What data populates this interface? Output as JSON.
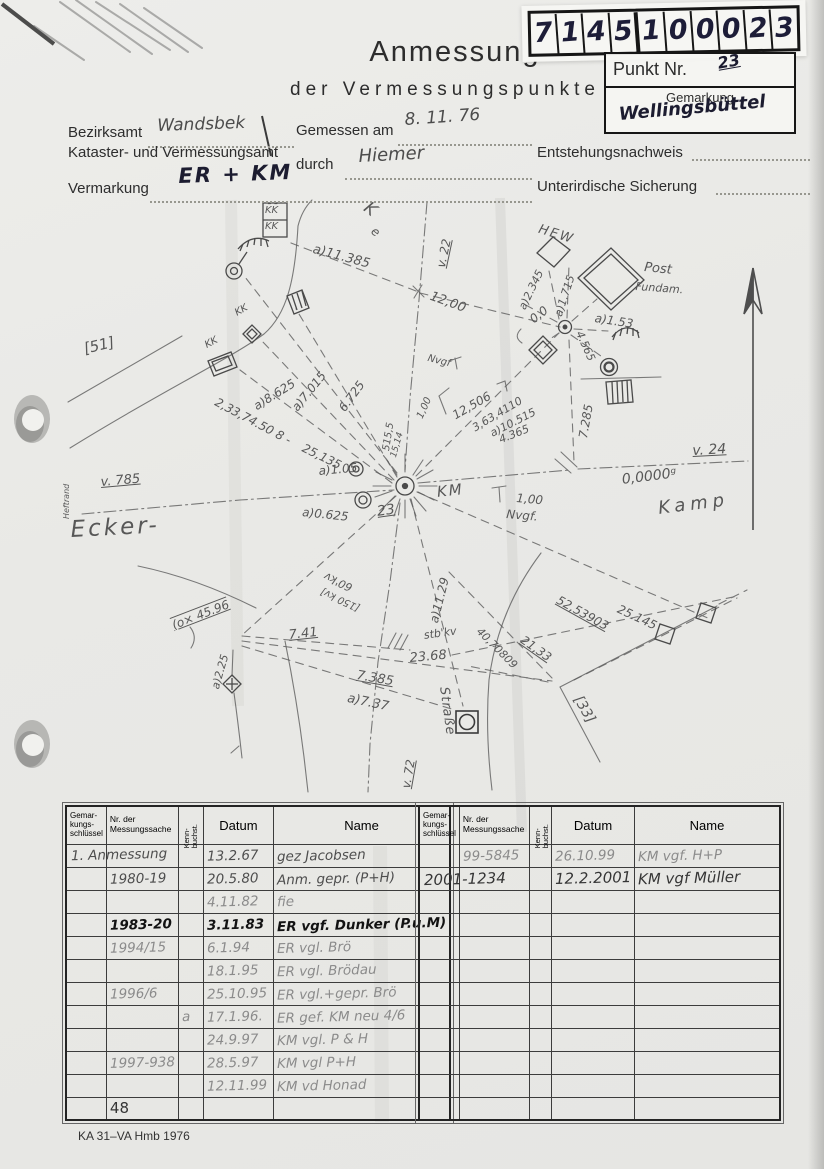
{
  "stamp": {
    "digits": [
      "7",
      "1",
      "4",
      "5",
      "1",
      "0",
      "0",
      "0",
      "2",
      "3"
    ]
  },
  "title": {
    "line1": "Anmessung",
    "line2": "der Vermessungspunkte"
  },
  "point_box": {
    "label": "Punkt Nr.",
    "value": "23",
    "gemarkung_label": "Gemarkung",
    "gemarkung_value": "Wellingsbüttel"
  },
  "fields": {
    "bezirksamt_label": "Bezirksamt",
    "bezirksamt_value": "Wandsbek",
    "amt_line": "Kataster- und Vermessungsamt",
    "gemessen_label": "Gemessen am",
    "gemessen_value": "8. 11. 76",
    "durch_label": "durch",
    "durch_value": "Hiemer",
    "entstehung_label": "Entstehungsnachweis",
    "vermarkung_label": "Vermarkung",
    "vermarkung_value": "ER + KM",
    "sicherung_label": "Unterirdische Sicherung"
  },
  "sketch": {
    "labels": [
      {
        "t": "K",
        "x": 372,
        "y": 198,
        "r": 38,
        "fs": 17
      },
      {
        "t": "e",
        "x": 377,
        "y": 224,
        "r": 38,
        "fs": 12
      },
      {
        "t": "v. 22",
        "x": 434,
        "y": 266,
        "r": -78,
        "fs": 12,
        "u": 1
      },
      {
        "t": "a)11.385",
        "x": 315,
        "y": 242,
        "r": 15,
        "fs": 13
      },
      {
        "t": "12,00",
        "x": 433,
        "y": 289,
        "r": 20,
        "fs": 13
      },
      {
        "t": "HEW",
        "x": 541,
        "y": 222,
        "r": 17,
        "fs": 13,
        "sp": 2
      },
      {
        "t": "Post",
        "x": 645,
        "y": 260,
        "r": 6,
        "fs": 13
      },
      {
        "t": "Fundam.",
        "x": 636,
        "y": 280,
        "r": 4,
        "fs": 11
      },
      {
        "t": "a)2.345",
        "x": 516,
        "y": 306,
        "r": -64,
        "fs": 11
      },
      {
        "t": "a)1.715",
        "x": 552,
        "y": 314,
        "r": -72,
        "fs": 11
      },
      {
        "t": "0,0",
        "x": 527,
        "y": 315,
        "r": -38,
        "fs": 12
      },
      {
        "t": "a)1.53",
        "x": 596,
        "y": 311,
        "r": 9,
        "fs": 12
      },
      {
        "t": "4.565",
        "x": 585,
        "y": 329,
        "r": 66,
        "fs": 11
      },
      {
        "t": "7.285",
        "x": 576,
        "y": 437,
        "r": -80,
        "fs": 12
      },
      {
        "t": "v. 24",
        "x": 692,
        "y": 443,
        "r": -3,
        "fs": 14,
        "u": 1
      },
      {
        "t": "0,0000ᵍ",
        "x": 621,
        "y": 472,
        "r": -7,
        "fs": 14
      },
      {
        "t": "Kamp",
        "x": 657,
        "y": 498,
        "r": -7,
        "fs": 18,
        "sp": 5
      },
      {
        "t": "Nvgf",
        "x": 429,
        "y": 353,
        "r": 14,
        "fs": 10
      },
      {
        "t": "1,00",
        "x": 415,
        "y": 416,
        "r": -66,
        "fs": 10
      },
      {
        "t": "12,506",
        "x": 450,
        "y": 410,
        "r": -30,
        "fs": 12
      },
      {
        "t": "3,63,4110",
        "x": 470,
        "y": 423,
        "r": -31,
        "fs": 11
      },
      {
        "t": "a)10.515",
        "x": 488,
        "y": 428,
        "r": -27,
        "fs": 11
      },
      {
        "t": "4.365",
        "x": 497,
        "y": 434,
        "r": -22,
        "fs": 11
      },
      {
        "t": "515,5",
        "x": 381,
        "y": 450,
        "r": -81,
        "fs": 10
      },
      {
        "t": "15,14",
        "x": 389,
        "y": 456,
        "r": -74,
        "fs": 9
      },
      {
        "t": "6.725",
        "x": 336,
        "y": 406,
        "r": -54,
        "fs": 12
      },
      {
        "t": "a)7.015",
        "x": 289,
        "y": 405,
        "r": -51,
        "fs": 12
      },
      {
        "t": "a)8.625",
        "x": 251,
        "y": 401,
        "r": -32,
        "fs": 12
      },
      {
        "t": "2,33,74.50 8 -",
        "x": 219,
        "y": 395,
        "r": 28,
        "fs": 12
      },
      {
        "t": "25,135",
        "x": 306,
        "y": 441,
        "r": 26,
        "fs": 12
      },
      {
        "t": "K̄K̄",
        "x": 265,
        "y": 205,
        "r": 0,
        "fs": 10
      },
      {
        "t": "K̄K̄",
        "x": 265,
        "y": 221,
        "r": 0,
        "fs": 10
      },
      {
        "t": "KK",
        "x": 233,
        "y": 309,
        "r": -30,
        "fs": 10
      },
      {
        "t": "KK",
        "x": 203,
        "y": 341,
        "r": -28,
        "fs": 10
      },
      {
        "t": "[51]",
        "x": 82,
        "y": 340,
        "r": -13,
        "fs": 15
      },
      {
        "t": "v. 785",
        "x": 100,
        "y": 475,
        "r": -5,
        "fs": 13,
        "u": 1
      },
      {
        "t": "Heftrand",
        "x": 62,
        "y": 519,
        "r": -90,
        "fs": 8
      },
      {
        "t": "Ecker-",
        "x": 70,
        "y": 517,
        "r": -3,
        "fs": 23,
        "sp": 3
      },
      {
        "t": "a)1.05",
        "x": 318,
        "y": 464,
        "r": -5,
        "fs": 12
      },
      {
        "t": "a)0.625",
        "x": 303,
        "y": 505,
        "r": 6,
        "fs": 12
      },
      {
        "t": "23",
        "x": 376,
        "y": 504,
        "r": -8,
        "fs": 14,
        "u": 1
      },
      {
        "t": "KM",
        "x": 436,
        "y": 483,
        "r": -6,
        "fs": 15,
        "sp": 2
      },
      {
        "t": "1,00",
        "x": 517,
        "y": 491,
        "r": 5,
        "fs": 12
      },
      {
        "t": "Nvgf.",
        "x": 507,
        "y": 507,
        "r": 5,
        "fs": 12
      },
      {
        "t": "(o× 45.96",
        "x": 170,
        "y": 619,
        "r": -21,
        "fs": 12,
        "uo": 1
      },
      {
        "t": "a)2.25",
        "x": 209,
        "y": 687,
        "r": -74,
        "fs": 11
      },
      {
        "t": "7.41",
        "x": 288,
        "y": 628,
        "r": -6,
        "fs": 13,
        "u": 1
      },
      {
        "t": "stb'kv",
        "x": 423,
        "y": 629,
        "r": -8,
        "fs": 11
      },
      {
        "t": "23.68",
        "x": 409,
        "y": 651,
        "r": -5,
        "fs": 13
      },
      {
        "t": "7.385",
        "x": 358,
        "y": 668,
        "r": 10,
        "fs": 13,
        "u": 1
      },
      {
        "t": "a)7.37",
        "x": 349,
        "y": 691,
        "r": 12,
        "fs": 13
      },
      {
        "t": "60'kv",
        "x": 349,
        "y": 594,
        "r": 205,
        "fs": 11
      },
      {
        "t": "[150 kv]",
        "x": 357,
        "y": 613,
        "r": 205,
        "fs": 10
      },
      {
        "t": "a)11.29",
        "x": 427,
        "y": 621,
        "r": -76,
        "fs": 12
      },
      {
        "t": "v. 72",
        "x": 399,
        "y": 787,
        "r": -80,
        "fs": 12,
        "u": 1
      },
      {
        "t": "Straße",
        "x": 451,
        "y": 686,
        "r": 82,
        "fs": 13,
        "sp": 1
      },
      {
        "t": "52,53903",
        "x": 561,
        "y": 593,
        "r": 29,
        "fs": 12,
        "u": 1
      },
      {
        "t": "25.145",
        "x": 621,
        "y": 602,
        "r": 25,
        "fs": 12
      },
      {
        "t": "21,33",
        "x": 526,
        "y": 633,
        "r": 35,
        "fs": 12,
        "u": 1
      },
      {
        "t": "40,70809",
        "x": 483,
        "y": 625,
        "r": 45,
        "fs": 11
      },
      {
        "t": "[33]",
        "x": 584,
        "y": 693,
        "r": 60,
        "fs": 14
      }
    ]
  },
  "left_table": {
    "col_widths": [
      35,
      70,
      25,
      70,
      143
    ],
    "headers": {
      "g": "Gemar-\nkungs-\nschlüssel",
      "nr": "Nr. der\nMessungssache",
      "kenn": "Kenn-\nbuchst.",
      "datum": "Datum",
      "name": "Name"
    },
    "rows": [
      {
        "g": "1. Anmessung",
        "nr": "",
        "kenn": "",
        "datum": "13.2.67",
        "name": "gez Jacobsen",
        "tone": "mid",
        "gspan": true
      },
      {
        "g": "",
        "nr": "1980-19",
        "kenn": "",
        "datum": "20.5.80",
        "name": "Anm. gepr. (P+H)",
        "tone": "mid"
      },
      {
        "g": "",
        "nr": "",
        "kenn": "",
        "datum": "4.11.82",
        "name": "fie",
        "tone": "light"
      },
      {
        "g": "",
        "nr": "1983-20",
        "kenn": "",
        "datum": "3.11.83",
        "name": "ER vgf. Dunker (P.u.M)",
        "tone": "ink"
      },
      {
        "g": "",
        "nr": "1994/15",
        "kenn": "",
        "datum": "6.1.94",
        "name": "ER vgl. Brö",
        "tone": "light"
      },
      {
        "g": "",
        "nr": "",
        "kenn": "",
        "datum": "18.1.95",
        "name": "ER vgl. Brödau",
        "tone": "light"
      },
      {
        "g": "",
        "nr": "1996/6",
        "kenn": "",
        "datum": "25.10.95",
        "name": "ER vgl.+gepr. Brö",
        "tone": "light"
      },
      {
        "g": "",
        "nr": "",
        "kenn": "a",
        "datum": "17.1.96.",
        "name": "ER gef. KM neu 4/6",
        "tone": "light"
      },
      {
        "g": "",
        "nr": "",
        "kenn": "",
        "datum": "24.9.97",
        "name": "KM vgl. P & H",
        "tone": "light"
      },
      {
        "g": "",
        "nr": "1997-938",
        "kenn": "",
        "datum": "28.5.97",
        "name": "KM vgl P+H",
        "tone": "light"
      },
      {
        "g": "",
        "nr": "",
        "kenn": "",
        "datum": "12.11.99",
        "name": "KM vd Honad",
        "tone": "light"
      },
      {
        "g": "",
        "nr": "48",
        "kenn": "",
        "datum": "",
        "name": "",
        "tone": "dark",
        "big": true
      }
    ]
  },
  "right_table": {
    "col_widths": [
      30,
      70,
      22,
      75,
      145
    ],
    "headers": {
      "g": "Gemar-\nkungs-\nschlüssel",
      "nr": "Nr. der\nMessungssache",
      "kenn": "Kenn-\nbuchst.",
      "datum": "Datum",
      "name": "Name"
    },
    "rows": [
      {
        "g": "",
        "nr": "99-5845",
        "kenn": "",
        "datum": "26.10.99",
        "name": "KM vgf. H+P",
        "tone": "light"
      },
      {
        "g": "2001-1234",
        "nr": "",
        "kenn": "",
        "datum": "12.2.2001",
        "name": "KM vgf  Müller",
        "tone": "dark",
        "gspan": true
      },
      {
        "g": "",
        "nr": "",
        "kenn": "",
        "datum": "",
        "name": "",
        "tone": "light"
      },
      {
        "g": "",
        "nr": "",
        "kenn": "",
        "datum": "",
        "name": "",
        "tone": "light"
      },
      {
        "g": "",
        "nr": "",
        "kenn": "",
        "datum": "",
        "name": "",
        "tone": "light"
      },
      {
        "g": "",
        "nr": "",
        "kenn": "",
        "datum": "",
        "name": "",
        "tone": "light"
      },
      {
        "g": "",
        "nr": "",
        "kenn": "",
        "datum": "",
        "name": "",
        "tone": "light"
      },
      {
        "g": "",
        "nr": "",
        "kenn": "",
        "datum": "",
        "name": "",
        "tone": "light"
      },
      {
        "g": "",
        "nr": "",
        "kenn": "",
        "datum": "",
        "name": "",
        "tone": "light"
      },
      {
        "g": "",
        "nr": "",
        "kenn": "",
        "datum": "",
        "name": "",
        "tone": "light"
      },
      {
        "g": "",
        "nr": "",
        "kenn": "",
        "datum": "",
        "name": "",
        "tone": "light"
      },
      {
        "g": "",
        "nr": "",
        "kenn": "",
        "datum": "",
        "name": "",
        "tone": "light"
      }
    ]
  },
  "footer": {
    "form_code": "KA 31–VA Hmb 1976"
  },
  "colors": {
    "pencil": "#5d5d5d",
    "ink": "#1d1d38",
    "paper": "#e9e9e6"
  }
}
